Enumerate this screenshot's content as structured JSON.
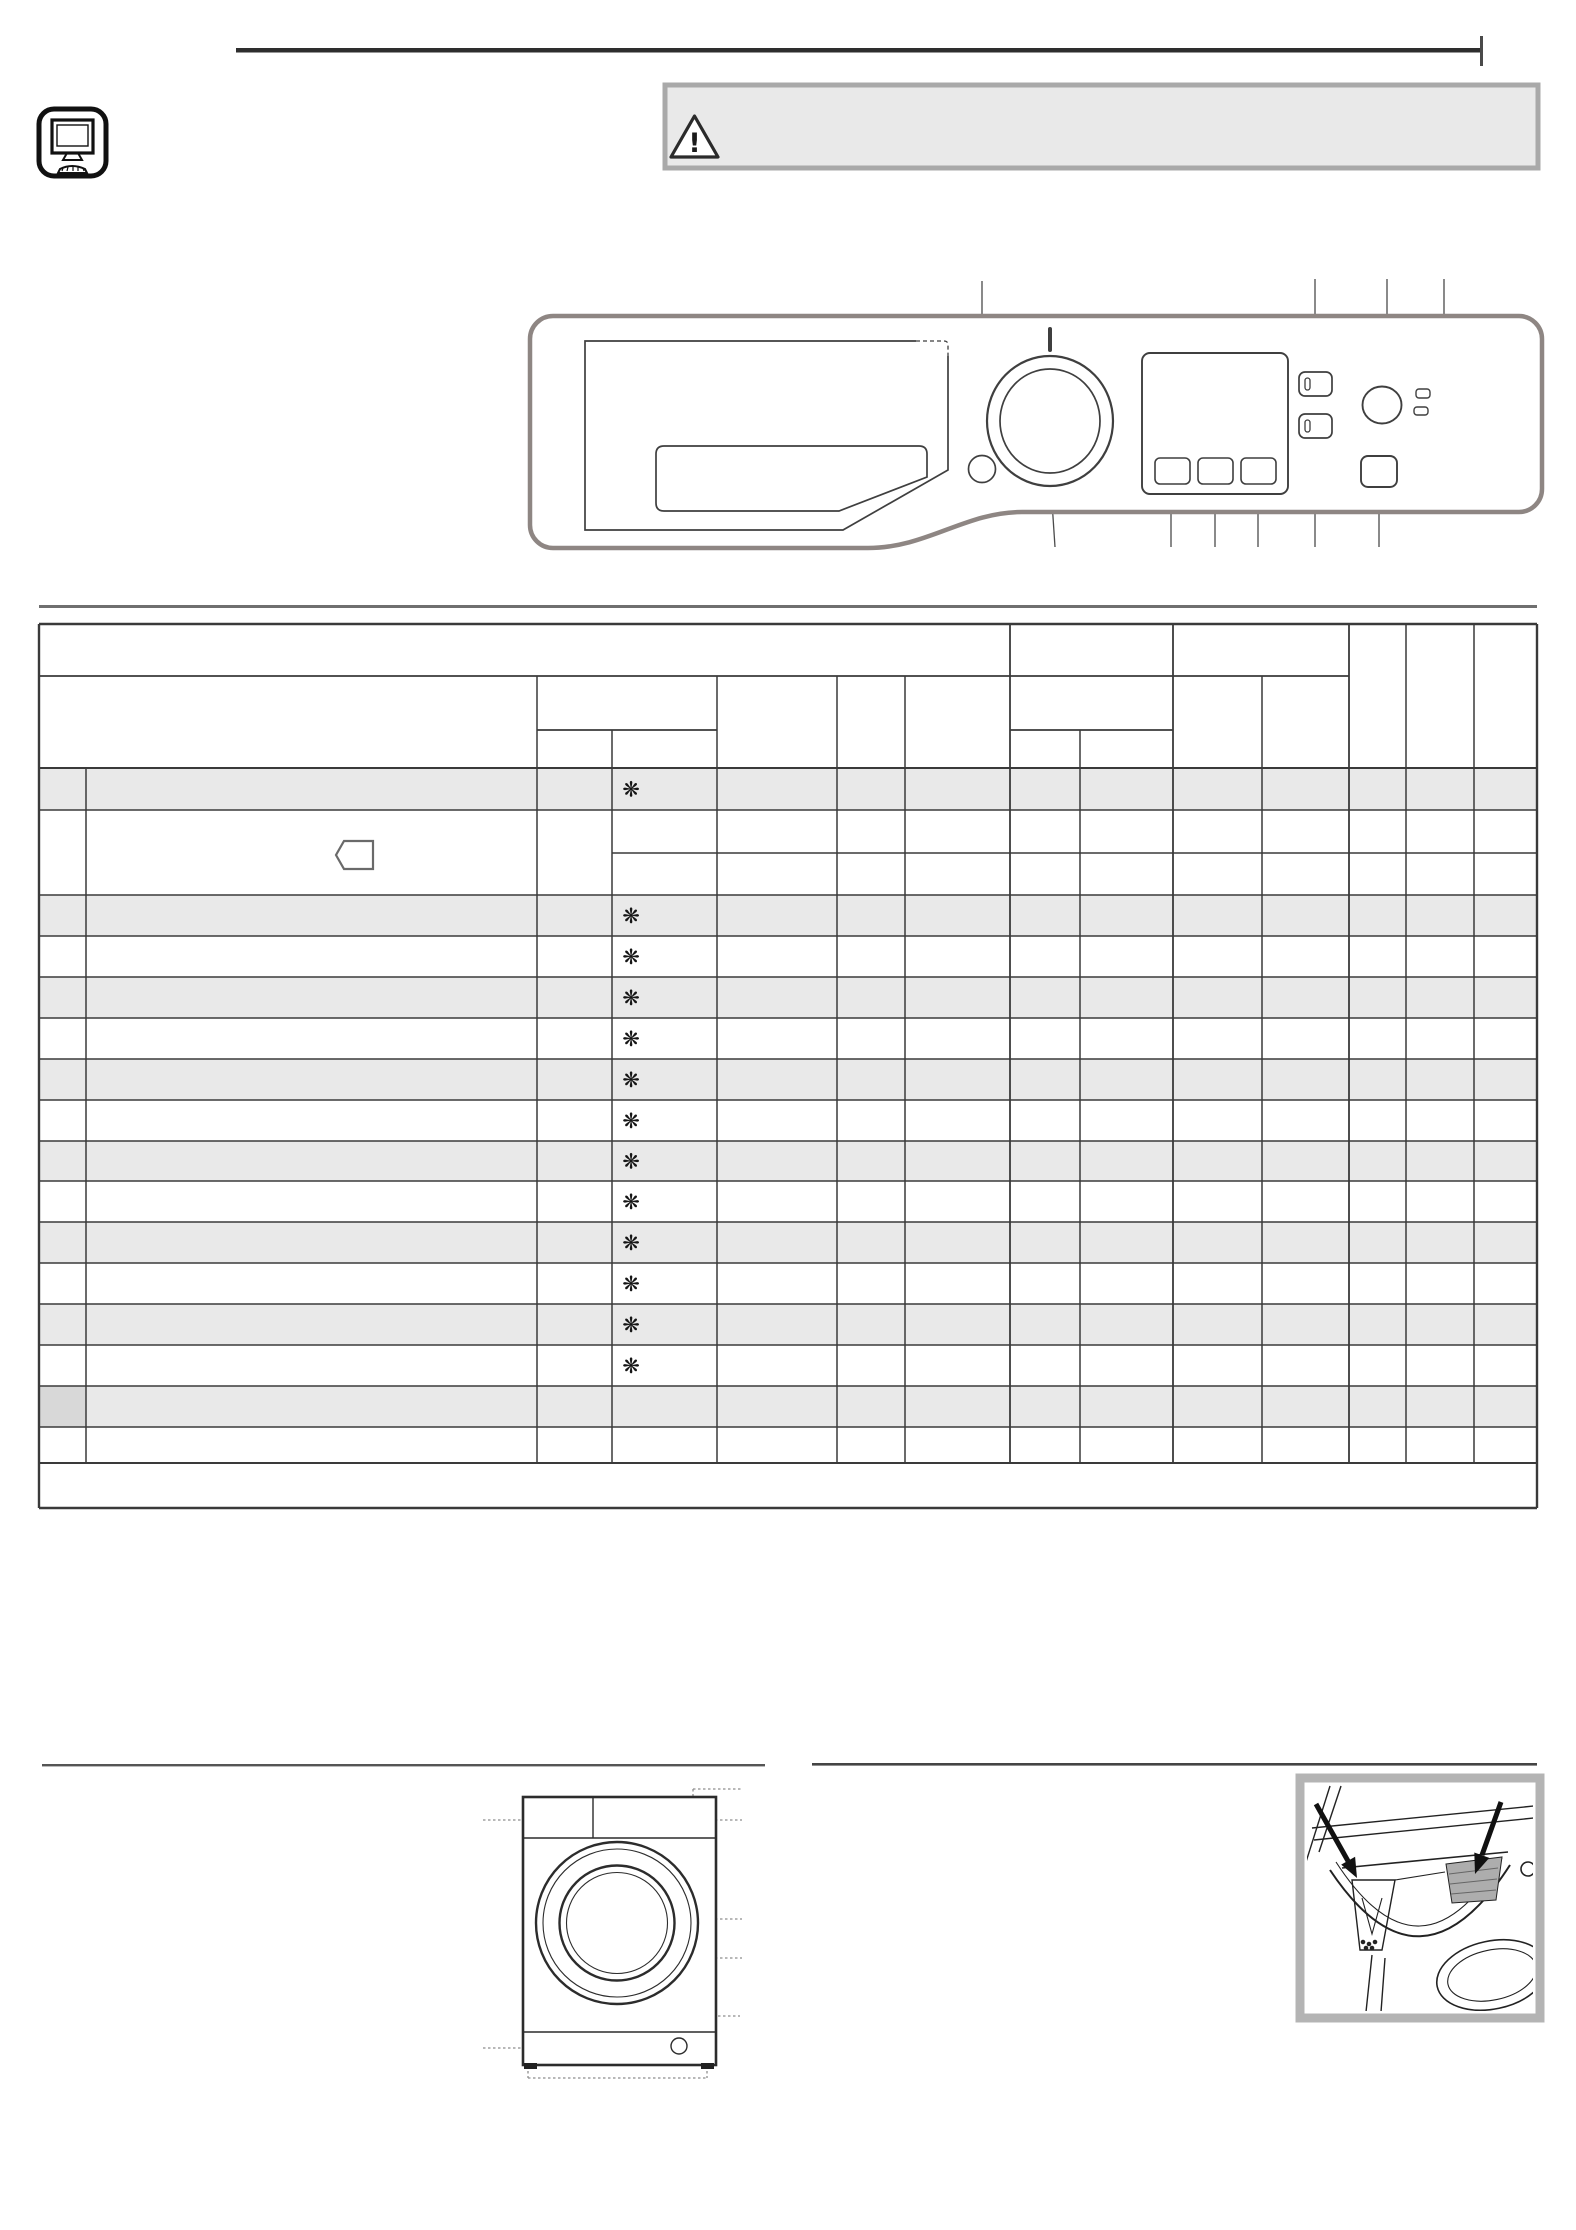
{
  "page": {
    "background": "#ffffff"
  },
  "top_bar": {
    "rule_color": "#2e2e2e",
    "tick_color": "#4a4a4a",
    "doc_icon": "computer-monitor-icon"
  },
  "warning_box": {
    "fill": "#e9e9e9",
    "border_color": "#a9a9a9",
    "icon": "warning-triangle-icon",
    "symbol": "!"
  },
  "control_panel_figure": {
    "outline_color": "#8e8683",
    "line_color": "#3f3f3f",
    "parts": [
      "detergent-drawer",
      "program-knob",
      "knob-position-indicator",
      "option-circle-button",
      "display-screen",
      "display-button-1",
      "display-button-2",
      "display-button-3",
      "function-button-top",
      "function-button-bottom",
      "power-button",
      "indicator-led-1",
      "indicator-led-2",
      "start-pause-button"
    ],
    "callout_color": "#4a4a4a"
  },
  "program_table": {
    "grid_color": "#3a3a3a",
    "shaded_row_fill": "#e9e9e9",
    "highlighted_cell_fill": "#d8d8d8",
    "snowflake_symbol": "❋",
    "snowflake_rows": [
      1,
      3,
      4,
      5,
      6,
      7,
      8,
      9,
      10,
      11,
      12,
      13,
      14
    ],
    "program_row_count": 16,
    "eco_label_icon": "energy-label-tag-icon"
  },
  "section_rules": {
    "color_top": "#6f6f6f",
    "color_bottom_left": "#555555",
    "color_bottom_right": "#444444"
  },
  "washer_figure": {
    "name": "washer-front-view-diagram",
    "outline_color": "#2c2c2c",
    "leader_color": "#8e8e8e",
    "parts": [
      "detergent-drawer-compartment",
      "control-panel-area",
      "porthole-door",
      "door-glass",
      "kick-plate",
      "drain-pump-access",
      "adjustable-feet"
    ]
  },
  "drawer_figure": {
    "name": "detergent-drawer-photo",
    "frame_color": "#b4b4b4",
    "arrow_color": "#111111",
    "parts": [
      "prewash-compartment-arrow",
      "softener-compartment-arrow"
    ]
  }
}
